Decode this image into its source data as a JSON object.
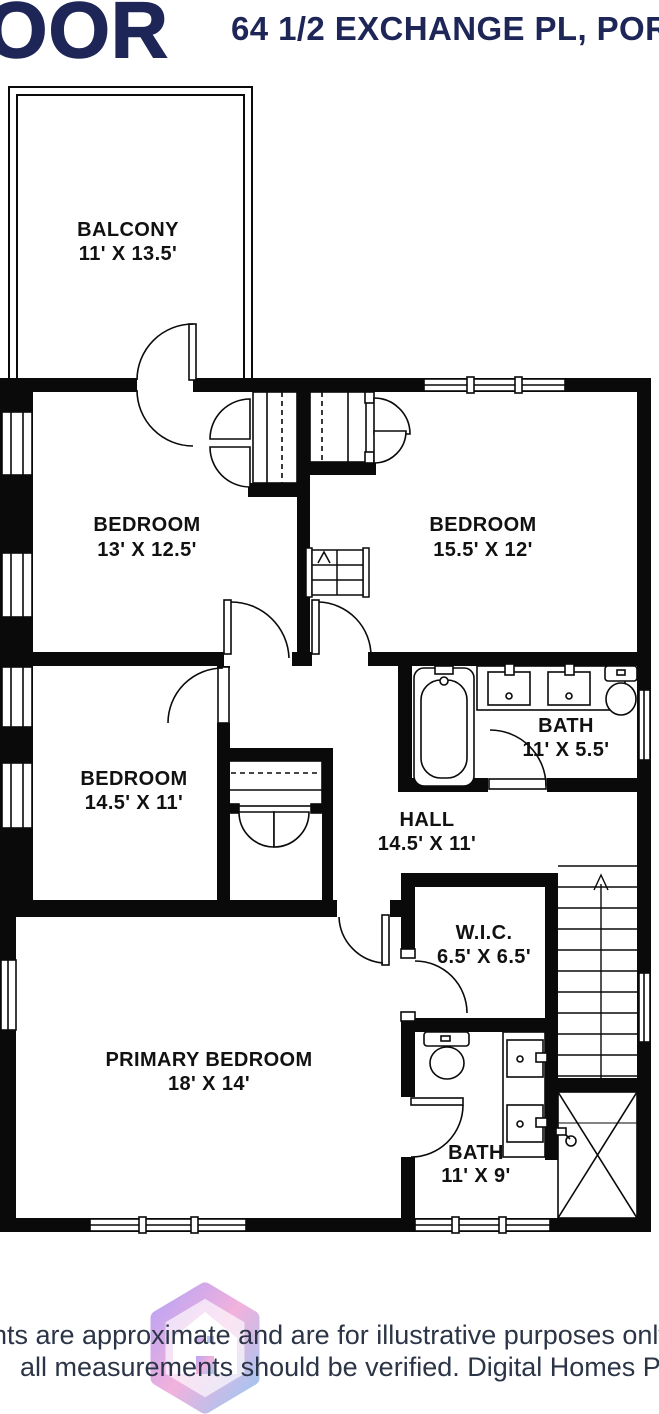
{
  "header": {
    "floor_label": "OOR",
    "address": "64 1/2 EXCHANGE PL, PORT",
    "text_color": "#1e2657"
  },
  "plan": {
    "line_color": "#0a0a0a",
    "rooms": [
      {
        "name": "BALCONY",
        "dims": "11' X 13.5'"
      },
      {
        "name": "BEDROOM",
        "dims": "13' X 12.5'"
      },
      {
        "name": "BEDROOM",
        "dims": "15.5' X 12'"
      },
      {
        "name": "BEDROOM",
        "dims": "14.5' X 11'"
      },
      {
        "name": "BATH",
        "dims": "11' X 5.5'"
      },
      {
        "name": "HALL",
        "dims": "14.5' X 11'"
      },
      {
        "name": "W.I.C.",
        "dims": "6.5' X 6.5'"
      },
      {
        "name": "PRIMARY BEDROOM",
        "dims": "18' X 14'"
      },
      {
        "name": "BATH",
        "dims": "11' X 9'"
      }
    ]
  },
  "footer": {
    "line1": "nts are approximate and are for illustrative purposes only. Whil",
    "line2": "all measurements should be verified. Digital Homes Photograph",
    "logo_colors": {
      "purple": "#a98df2",
      "pink": "#ef9fd4",
      "blue": "#86b9f0"
    }
  }
}
